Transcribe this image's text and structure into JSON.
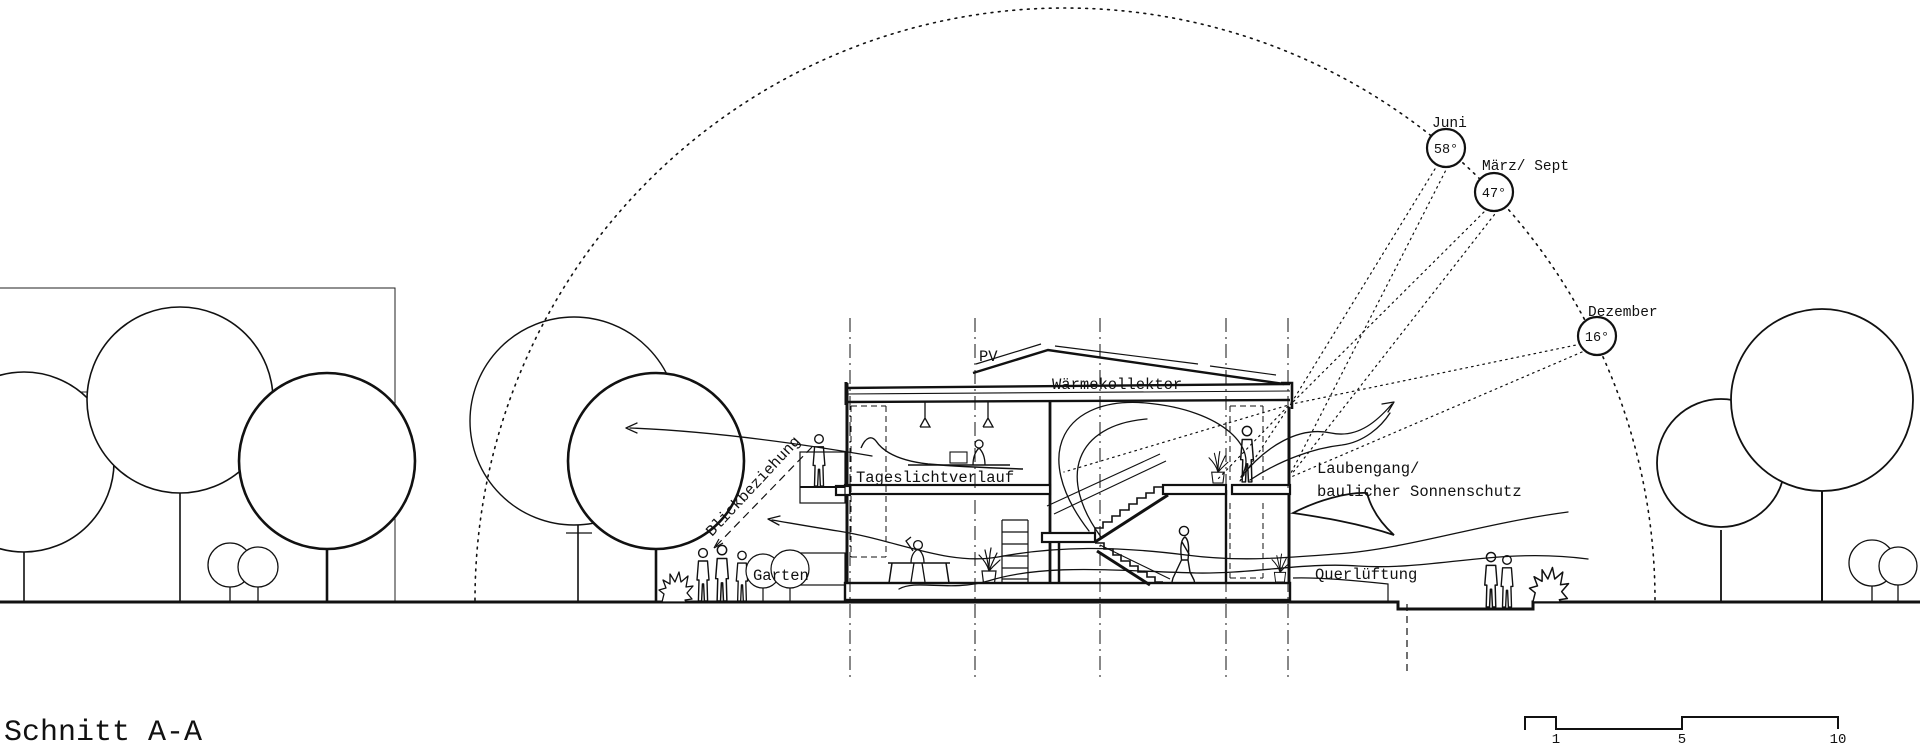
{
  "title": "Schnitt A-A",
  "colors": {
    "ink": "#111111",
    "paper": "#ffffff"
  },
  "sun_path": {
    "positions": [
      {
        "name": "Juni",
        "angle": "58°"
      },
      {
        "name": "März/ Sept",
        "angle": "47°"
      },
      {
        "name": "Dezember",
        "angle": "16°"
      }
    ]
  },
  "labels": {
    "pv": "PV",
    "heat_collector": "Wärmekollektor",
    "daylight": "Tageslichtverlauf",
    "view_relation": "Blickbeziehung",
    "garden": "Garten",
    "cross_ventilation": "Querlüftung",
    "pergola_line1": "Laubengang/",
    "pergola_line2": "baulicher Sonnenschutz"
  },
  "scale_bar": {
    "ticks": [
      "1",
      "5",
      "10"
    ]
  }
}
